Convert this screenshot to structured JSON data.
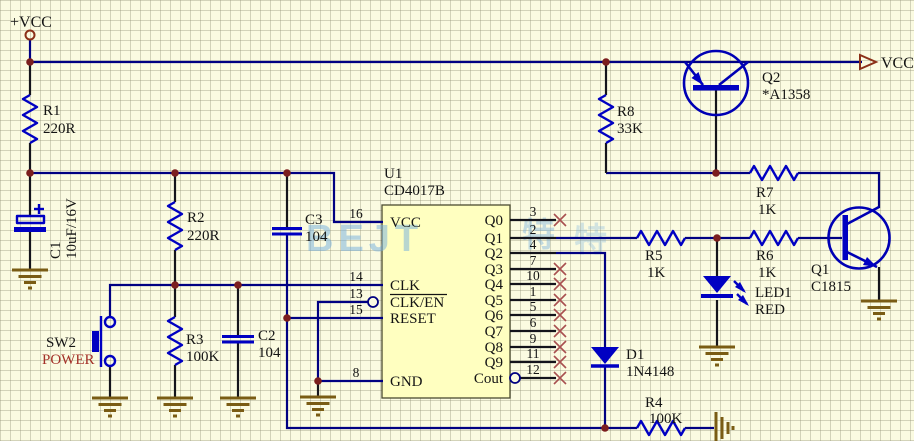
{
  "schematic": {
    "power": {
      "input_label": "+VCC",
      "output_label": "VCC"
    },
    "watermark": {
      "latin": "BEJT",
      "cjk1": "特",
      "cjk2": "特"
    },
    "resistors": {
      "r1": {
        "ref": "R1",
        "value": "220R"
      },
      "r2": {
        "ref": "R2",
        "value": "220R"
      },
      "r3": {
        "ref": "R3",
        "value": "100K"
      },
      "r4": {
        "ref": "R4",
        "value": "100K"
      },
      "r5": {
        "ref": "R5",
        "value": "1K"
      },
      "r6": {
        "ref": "R6",
        "value": "1K"
      },
      "r7": {
        "ref": "R7",
        "value": "1K"
      },
      "r8": {
        "ref": "R8",
        "value": "33K"
      }
    },
    "capacitors": {
      "c1": {
        "ref": "C1",
        "value": "10uF/16V"
      },
      "c2": {
        "ref": "C2",
        "value": "104"
      },
      "c3": {
        "ref": "C3",
        "value": "104"
      }
    },
    "diodes": {
      "d1": {
        "ref": "D1",
        "value": "1N4148"
      },
      "led1": {
        "ref": "LED1",
        "value": "RED"
      }
    },
    "transistors": {
      "q1": {
        "ref": "Q1",
        "value": "C1815"
      },
      "q2": {
        "ref": "Q2",
        "value": "*A1358"
      }
    },
    "switch": {
      "ref": "SW2",
      "value": "POWER"
    },
    "ic": {
      "ref": "U1",
      "part": "CD4017B",
      "left_pins": [
        {
          "num": "16",
          "name": "VCC"
        },
        {
          "num": "14",
          "name": "CLK"
        },
        {
          "num": "13",
          "name": "CLK/EN",
          "inverted": true
        },
        {
          "num": "15",
          "name": "RESET"
        },
        {
          "num": "8",
          "name": "GND"
        }
      ],
      "right_pins": [
        {
          "num": "3",
          "name": "Q0",
          "nc": true
        },
        {
          "num": "2",
          "name": "Q1",
          "nc": false
        },
        {
          "num": "4",
          "name": "Q2",
          "nc": false
        },
        {
          "num": "7",
          "name": "Q3",
          "nc": true
        },
        {
          "num": "10",
          "name": "Q4",
          "nc": true
        },
        {
          "num": "1",
          "name": "Q5",
          "nc": true
        },
        {
          "num": "5",
          "name": "Q6",
          "nc": true
        },
        {
          "num": "6",
          "name": "Q7",
          "nc": true
        },
        {
          "num": "9",
          "name": "Q8",
          "nc": true
        },
        {
          "num": "11",
          "name": "Q9",
          "nc": true
        },
        {
          "num": "12",
          "name": "Cout",
          "nc": true,
          "inverted": true
        }
      ]
    },
    "colors": {
      "background": "#fbfbe1",
      "wire": "#000082",
      "symbol_blue": "#0000c2",
      "junction": "#7b1e1e",
      "ground": "#7a5c14",
      "nc_mark": "#a85050",
      "ic_fill": "#ffffc0",
      "power_text_red": "#a33028",
      "terminal": "#8b3018",
      "watermark_blue": "#74aede"
    }
  }
}
